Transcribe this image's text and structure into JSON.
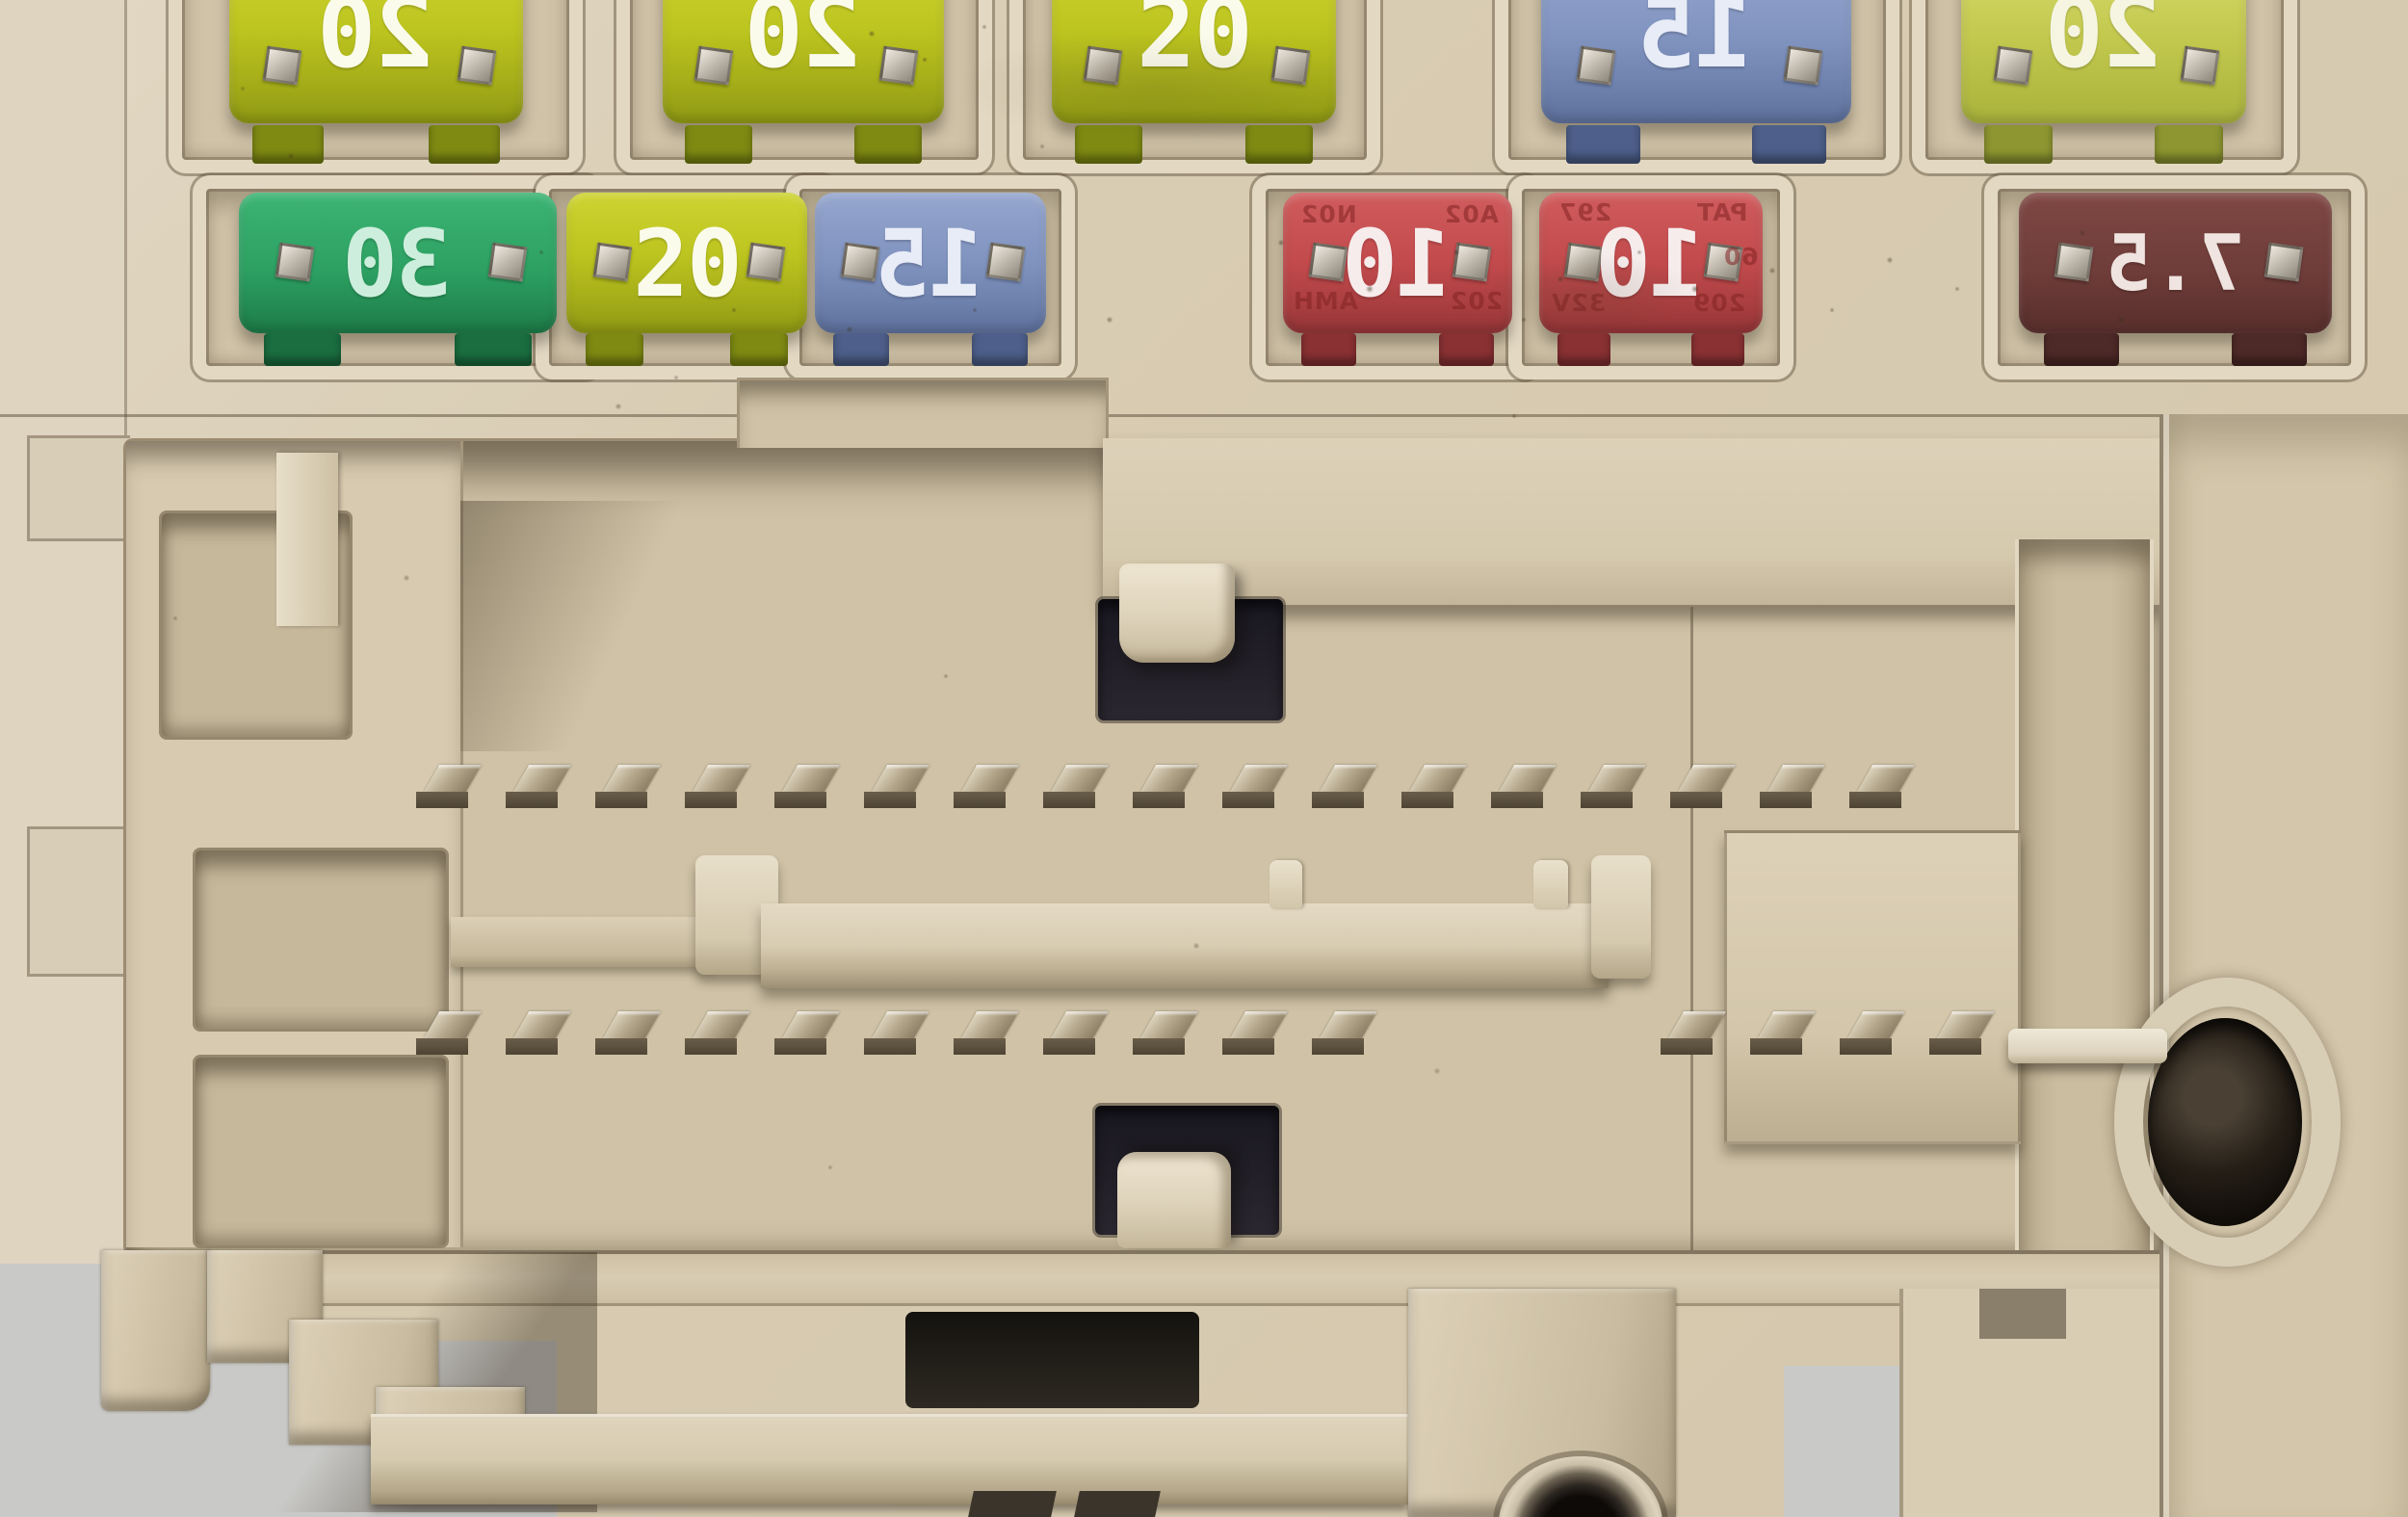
{
  "scene": {
    "type": "photograph",
    "subject": "Close-up of a vehicle fuse box: two rows of mini blade fuses above a large wiring-harness connector socket",
    "plastic_color": "#d6c9ae",
    "cavity_color": "#cfc2a6",
    "photo_background_color": "#c9c9c7"
  },
  "fuse_rows": {
    "row1": {
      "fuses": [
        {
          "amperage": "20",
          "color_name": "yellow-green",
          "body_color": "#bcc41f",
          "text_color": "#fbfbec",
          "mirrored": true
        },
        {
          "amperage": "20",
          "color_name": "yellow-green",
          "body_color": "#bcc41f",
          "text_color": "#fbfbec",
          "mirrored": true
        },
        {
          "amperage": "20",
          "color_name": "yellow",
          "body_color": "#c4ca28",
          "text_color": "#fbfbec",
          "mirrored": false
        },
        {
          "amperage": "15",
          "color_name": "blue-grey",
          "body_color": "#8093bf",
          "text_color": "#e8ecf7",
          "mirrored": true
        },
        {
          "amperage": "20",
          "color_name": "pale-yellow-green",
          "body_color": "#c2c84d",
          "text_color": "#f5f5e2",
          "mirrored": true
        }
      ]
    },
    "row2": {
      "fuses": [
        {
          "amperage": "30",
          "color_name": "green",
          "body_color": "#2da162",
          "text_color": "#cdeedd",
          "mirrored": true
        },
        {
          "amperage": "20",
          "color_name": "yellow",
          "body_color": "#bcc41f",
          "text_color": "#fbfbec",
          "mirrored": false
        },
        {
          "amperage": "15",
          "color_name": "blue-grey",
          "body_color": "#8093bf",
          "text_color": "#e8ecf7",
          "mirrored": true
        },
        {
          "amperage": "10",
          "color_name": "red",
          "body_color": "#c24a4c",
          "text_color": "#f6ecec",
          "mirrored": true,
          "embossed_markings": [
            "N02",
            "A02",
            "AMH",
            "202"
          ]
        },
        {
          "amperage": "10",
          "color_name": "red",
          "body_color": "#c24a4c",
          "text_color": "#f6ecec",
          "mirrored": true,
          "embossed_markings": [
            "297",
            "PAT",
            "60",
            "32V",
            "209"
          ]
        },
        {
          "amperage": "7.5",
          "color_name": "dark-brown",
          "body_color": "#6f3d3a",
          "text_color": "#efe4df",
          "mirrored": true
        }
      ]
    }
  },
  "connector": {
    "upper_pin_row_count": 17,
    "lower_pin_row_left_count": 11,
    "lower_pin_row_right_count": 4,
    "pin_metal_color": "#b1a58a",
    "keyway_slot_color": "#23202a",
    "alignment_peg_count": 2
  },
  "right_panel": {
    "mounting_hole_color": "#1a150f"
  },
  "bottom": {
    "metal_insert_color": "#141110"
  }
}
